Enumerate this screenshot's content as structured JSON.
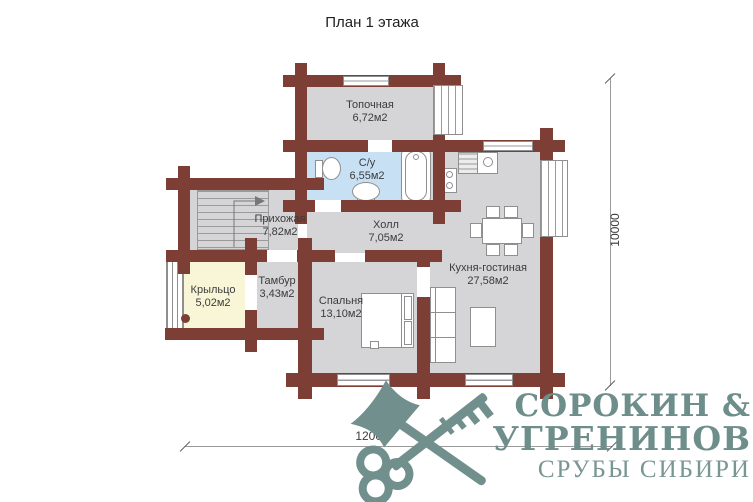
{
  "title": "План 1 этажа",
  "rooms": [
    {
      "name": "Топочная",
      "area": "6,72м2"
    },
    {
      "name": "С/у",
      "area": "6,55м2"
    },
    {
      "name": "Прихожая",
      "area": "7,82м2"
    },
    {
      "name": "Холл",
      "area": "7,05м2"
    },
    {
      "name": "Кухня-гостиная",
      "area": "27,58м2"
    },
    {
      "name": "Спальня",
      "area": "13,10м2"
    },
    {
      "name": "Тамбур",
      "area": "3,43м2"
    },
    {
      "name": "Крыльцо",
      "area": "5,02м2"
    }
  ],
  "dimensions": {
    "vertical": "10000",
    "horizontal": "12000"
  },
  "logo": {
    "line1": "СОРОКИН &",
    "line2": "УГРЕНИНОВ",
    "line3": "СРУБЫ СИБИРИ"
  },
  "colors": {
    "wall": "#7d3e35",
    "floor": "#d5d4d6",
    "bathroom_floor": "#c8e0f4",
    "porch_floor": "#f8f6d7",
    "logo": "#71908d"
  }
}
